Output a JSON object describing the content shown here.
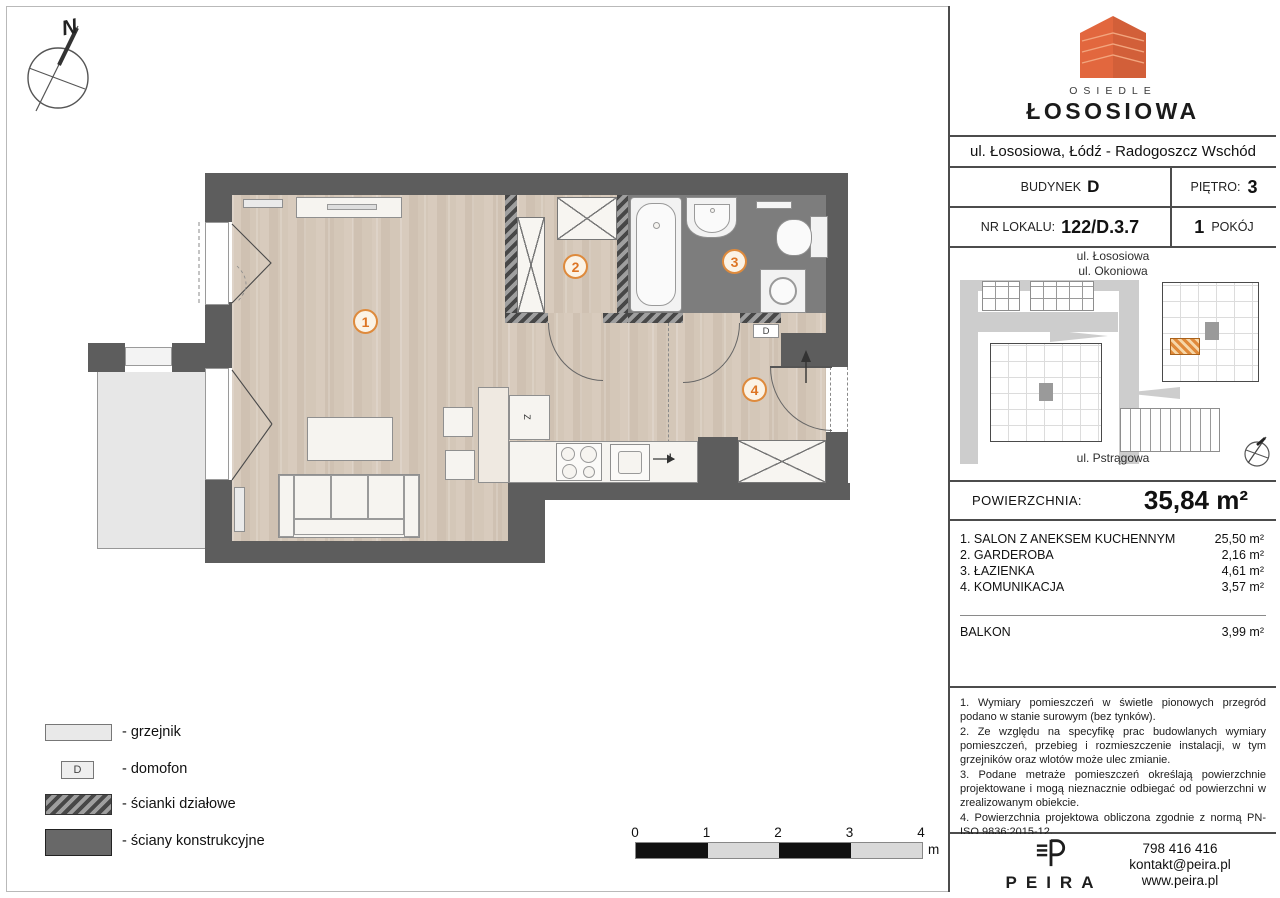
{
  "header": {
    "logo_osiedle": "OSIEDLE",
    "logo_name": "ŁOSOSIOWA",
    "address": "ul. Łososiowa, Łódź - Radogoszcz Wschód",
    "building_label": "BUDYNEK",
    "building_value": "D",
    "floor_label": "PIĘTRO:",
    "floor_value": "3",
    "unit_label": "NR LOKALU:",
    "unit_value": "122/D.3.7",
    "rooms_count": "1",
    "rooms_word": "POKÓJ"
  },
  "sitemap": {
    "street_top_1": "ul. Łososiowa",
    "street_top_2": "ul. Okoniowa",
    "street_bottom": "ul. Pstrągowa"
  },
  "area_summary": {
    "label": "POWIERZCHNIA:",
    "value": "35,84 m²"
  },
  "rooms": [
    {
      "name": "1. SALON Z ANEKSEM KUCHENNYM",
      "area": "25,50 m²"
    },
    {
      "name": "2. GARDEROBA",
      "area": "2,16 m²"
    },
    {
      "name": "3. ŁAZIENKA",
      "area": "4,61 m²"
    },
    {
      "name": "4. KOMUNIKACJA",
      "area": "3,57 m²"
    }
  ],
  "balcony_row": {
    "name": "BALKON",
    "area": "3,99 m²"
  },
  "notes": [
    "1. Wymiary pomieszczeń w świetle pionowych przegród podano w stanie surowym (bez tynków).",
    "2. Ze względu na specyfikę prac budowlanych wymiary pomieszczeń, przebieg i rozmieszczenie instalacji, w tym grzejników oraz wlotów może ulec zmianie.",
    "3. Podane metraże pomieszczeń określają powierzchnie projektowane i mogą nieznacznie odbiegać od powierzchni w zrealizowanym obiekcie.",
    "4. Powierzchnia projektowa obliczona zgodnie z normą PN-ISO 9836:2015-12."
  ],
  "footer": {
    "brand": "PEIRA",
    "phone": "798 416 416",
    "email": "kontakt@peira.pl",
    "website": "www.peira.pl"
  },
  "legend": [
    {
      "label": "- grzejnik"
    },
    {
      "label": "- domofon",
      "symbol": "D"
    },
    {
      "label": "- ścianki działowe"
    },
    {
      "label": "- ściany konstrukcyjne"
    }
  ],
  "scalebar": {
    "ticks": [
      "0",
      "1",
      "2",
      "3",
      "4"
    ],
    "unit": "m"
  },
  "compass": {
    "label": "N"
  },
  "plan": {
    "markers": [
      "1",
      "2",
      "3",
      "4"
    ],
    "labels": {
      "domofon": "D",
      "sink": "Z",
      "fridge": "L"
    }
  },
  "colors": {
    "accent_orange": "#e2673e",
    "marker_orange": "#dd7524",
    "wall_gray": "#5d5d5d",
    "bath_gray": "#7d7d7d",
    "wood": "#d3c6b8",
    "balcony_gray": "#e7e7e7"
  }
}
